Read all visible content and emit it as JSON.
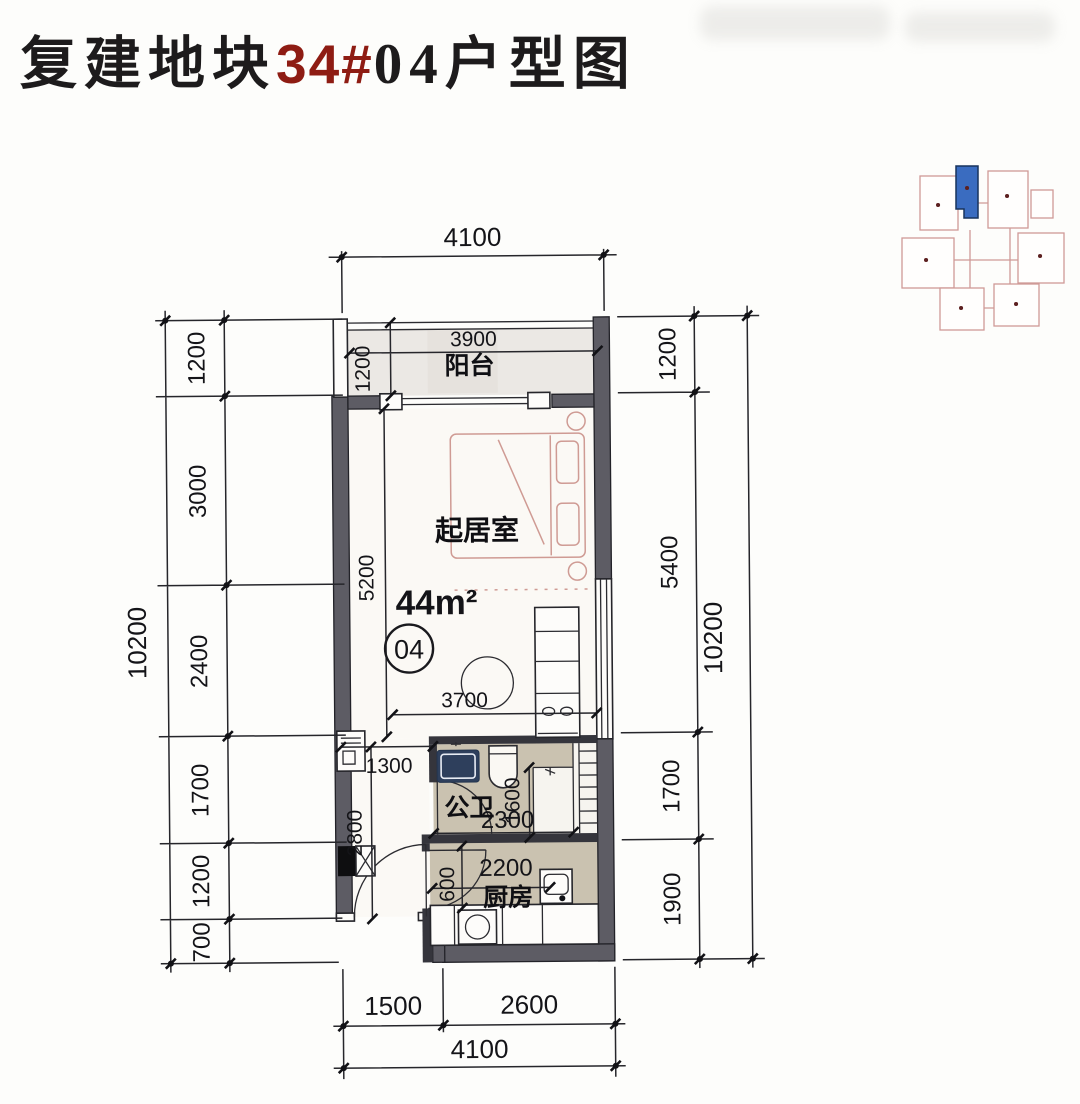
{
  "title": {
    "part1": "复建地块",
    "part2": "34#",
    "part3": "04",
    "part4": "户型图"
  },
  "unit": {
    "area": "44m²",
    "number": "04"
  },
  "rooms": {
    "balcony": "阳台",
    "living": "起居室",
    "bath": "公卫",
    "kitchen": "厨房"
  },
  "dims": {
    "top_total": "4100",
    "bottom_segments": [
      "1500",
      "2600"
    ],
    "bottom_total": "4100",
    "left_chain": [
      "1200",
      "3000",
      "2400",
      "1700",
      "1200",
      "700"
    ],
    "left_total": "10200",
    "right_chain": [
      "1200",
      "5400",
      "1700",
      "1900"
    ],
    "right_total": "10200",
    "interior": {
      "balcony_width": "3900",
      "balcony_depth": "1200",
      "living_height": "5200",
      "living_width": "3700",
      "hall_width": "1300",
      "hall_height": "2800",
      "bath_width": "2300",
      "bath_depth": "1600",
      "kitchen_width": "2200",
      "kitchen_door_offset": "600"
    }
  },
  "colors": {
    "accent_red": "#8e1c13",
    "wall_dark": "#5d5c64",
    "floor_tan": "#cac2b0",
    "balcony_grey": "#ebe8e4",
    "furniture_pink": "#cf9b94",
    "sink_navy": "#2e3f5c",
    "keyplan_pink": "#cf9a97",
    "keyplan_blue": "#3a6cc0"
  }
}
